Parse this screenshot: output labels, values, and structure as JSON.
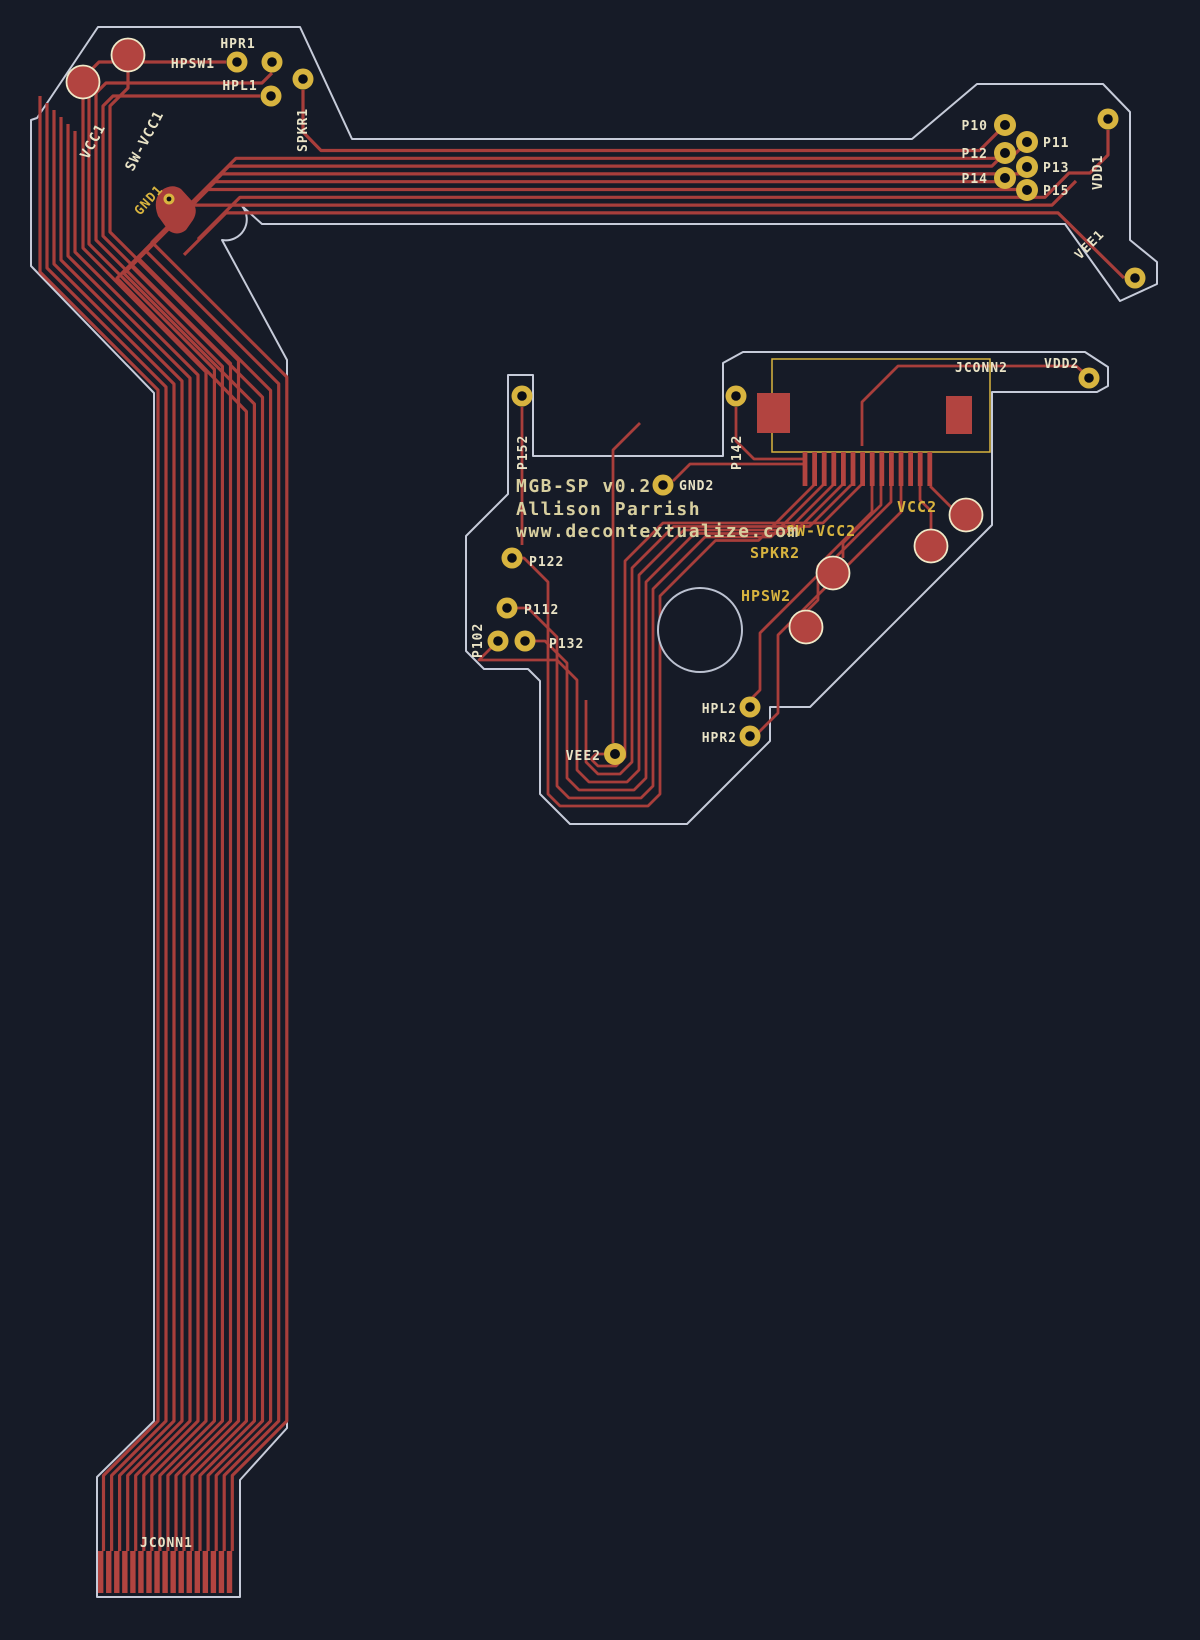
{
  "app": {
    "view_title": "PCB copper layout view"
  },
  "colors": {
    "background": "#161b27",
    "copper": "#a83e3b",
    "copper_bright": "#b24440",
    "pad_gold": "#d8b43f",
    "pad_hole": "#0b0e15",
    "big_pad_ring": "#efe9c8",
    "board_outline": "#c6cbd9",
    "hole_outline": "#bcc2d1",
    "silk_pale": "#e9e3c6",
    "silk_gold": "#d8b43f",
    "silk_text": "#d8cf9f"
  },
  "board1": {
    "name": "flex cable board",
    "labels": {
      "VCC1": "VCC1",
      "SW-VCC1": "SW-VCC1",
      "HPR1": "HPR1",
      "HPSW1": "HPSW1",
      "HPL1": "HPL1",
      "SPKR1": "SPKR1",
      "GND1": "GND1",
      "P10": "P10",
      "P11": "P11",
      "P12": "P12",
      "P13": "P13",
      "P14": "P14",
      "P15": "P15",
      "VDD1": "VDD1",
      "VEE1": "VEE1",
      "JCONN1": "JCONN1"
    }
  },
  "board2": {
    "name": "MGB-SP module board",
    "silkscreen": {
      "line1": "MGB-SP v0.2",
      "line2": "Allison Parrish",
      "line3": "www.decontextualize.com"
    },
    "labels": {
      "JCONN2": "JCONN2",
      "VDD2": "VDD2",
      "P152": "P152",
      "P142": "P142",
      "GND2": "GND2",
      "P122": "P122",
      "P112": "P112",
      "P102": "P102",
      "P132": "P132",
      "VEE2": "VEE2",
      "HPL2": "HPL2",
      "HPR2": "HPR2",
      "SPKR2": "SPKR2",
      "HPSW2": "HPSW2",
      "VCC2": "VCC2",
      "SW-VCC2": "SW-VCC2"
    }
  }
}
